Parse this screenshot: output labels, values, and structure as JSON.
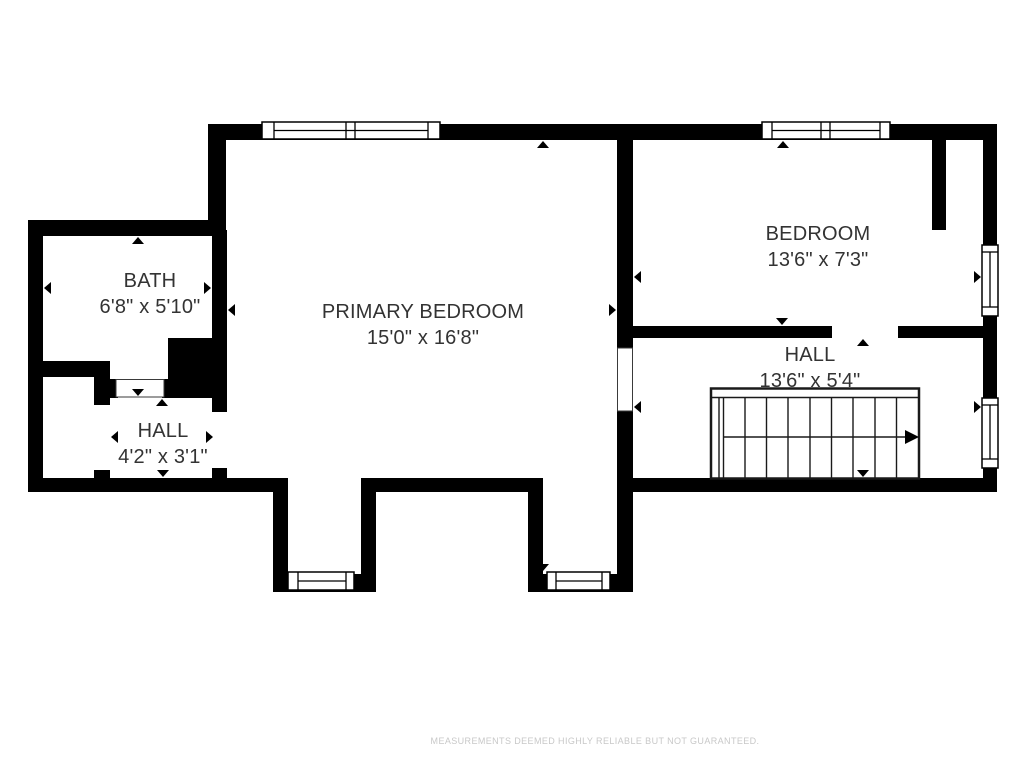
{
  "floor_plan": {
    "rooms": [
      {
        "name": "BATH",
        "dimensions": "6'8\" x 5'10\""
      },
      {
        "name": "HALL",
        "dimensions": "4'2\" x 3'1\""
      },
      {
        "name": "PRIMARY BEDROOM",
        "dimensions": "15'0\" x 16'8\""
      },
      {
        "name": "BEDROOM",
        "dimensions": "13'6\" x 7'3\""
      },
      {
        "name": "HALL",
        "dimensions": "13'6\" x 5'4\""
      }
    ],
    "disclaimer": "MEASUREMENTS DEEMED HIGHLY RELIABLE BUT NOT GUARANTEED.",
    "colors": {
      "wall": "#000000",
      "floor": "#ffffff",
      "room_text": "#333333",
      "disclaimer_text": "#c8c8c8",
      "stair_lines": "#1a1a1a"
    }
  }
}
